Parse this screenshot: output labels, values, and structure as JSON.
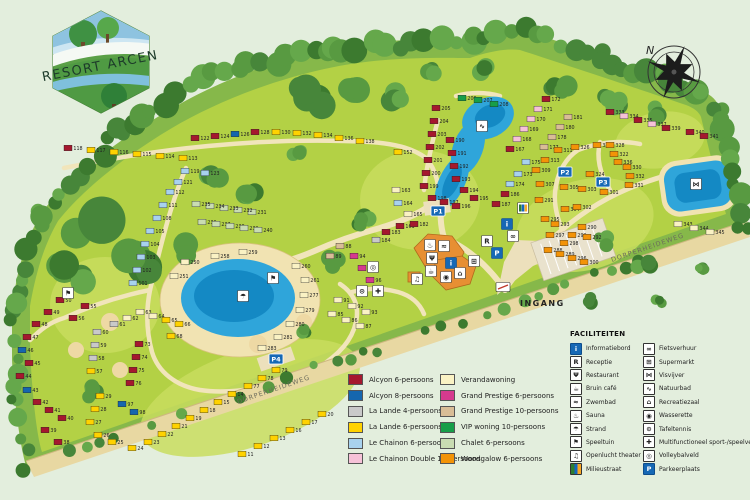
{
  "logo": {
    "title": "RESORT ARCEN"
  },
  "compass": {
    "north_label": "N"
  },
  "map_labels": {
    "entrance": "INGANG",
    "road_bottom": "DORPERHEIDEWEG",
    "road_right": "DORPERHEIDEWEG"
  },
  "parking_signs": [
    {
      "label": "P1",
      "x": 438,
      "y": 211
    },
    {
      "label": "P2",
      "x": 565,
      "y": 172
    },
    {
      "label": "P3",
      "x": 603,
      "y": 182
    },
    {
      "label": "P4",
      "x": 276,
      "y": 359
    }
  ],
  "unit_colors": {
    "a6": "#a5182e",
    "a8": "#1566ae",
    "l4": "#c9c9c9",
    "l6": "#ffd200",
    "c6": "#a8d2ee",
    "c12": "#f6c2d8",
    "vw": "#faf2c4",
    "gp6": "#d63a8e",
    "gp10": "#d9bd97",
    "vip": "#179e49",
    "ch": "#c9dcb2",
    "wg": "#f39307"
  },
  "accommodation_legend": [
    {
      "key": "a6",
      "label": "Alcyon 6-persoons",
      "color": "#a5182e"
    },
    {
      "key": "a8",
      "label": "Alcyon 8-persoons",
      "color": "#1566ae"
    },
    {
      "key": "l4",
      "label": "La Lande 4-persoons",
      "color": "#c9c9c9"
    },
    {
      "key": "l6",
      "label": "La Lande 6-persoons",
      "color": "#ffd200"
    },
    {
      "key": "c6",
      "label": "Le Chainon 6-persoons",
      "color": "#a8d2ee"
    },
    {
      "key": "c12",
      "label": "Le Chainon Double 12-persoons",
      "color": "#f6c2d8"
    },
    {
      "key": "vw",
      "label": "Verandawoning",
      "color": "#faf2c4"
    },
    {
      "key": "gp6",
      "label": "Grand Prestige 6-persoons",
      "color": "#d63a8e"
    },
    {
      "key": "gp10",
      "label": "Grand Prestige 10-persoons",
      "color": "#d9bd97"
    },
    {
      "key": "vip",
      "label": "VIP woning 10-persoons",
      "color": "#179e49"
    },
    {
      "key": "ch",
      "label": "Chalet 6-persoons",
      "color": "#c9dcb2"
    },
    {
      "key": "wg",
      "label": "Woodgalow 6-persoons",
      "color": "#f39307"
    }
  ],
  "facilities_legend": {
    "title": "FACILITEITEN",
    "left": [
      {
        "type": "informatiebord",
        "label": "Informatiebord"
      },
      {
        "type": "receptie",
        "label": "Receptie"
      },
      {
        "type": "restaurant",
        "label": "Restaurant"
      },
      {
        "type": "bruin-cafe",
        "label": "Bruin café"
      },
      {
        "type": "zwembad",
        "label": "Zwembad"
      },
      {
        "type": "sauna",
        "label": "Sauna"
      },
      {
        "type": "strand",
        "label": "Strand"
      },
      {
        "type": "speeltuin",
        "label": "Speeltuin"
      },
      {
        "type": "openlucht-theater",
        "label": "Openlucht theater"
      },
      {
        "type": "milieustraat",
        "label": "Milieustraat"
      }
    ],
    "right": [
      {
        "type": "fietsverhuur",
        "label": "Fietsverhuur"
      },
      {
        "type": "supermarkt",
        "label": "Supermarkt"
      },
      {
        "type": "visvijver",
        "label": "Visvijver"
      },
      {
        "type": "natuurbad",
        "label": "Natuurbad"
      },
      {
        "type": "recreatiezaal",
        "label": "Recreatiezaal"
      },
      {
        "type": "wasserette",
        "label": "Wasserette"
      },
      {
        "type": "tafeltennis",
        "label": "Tafeltennis"
      },
      {
        "type": "multifunctioneel",
        "label": "Multifunctioneel sport-/speelveld"
      },
      {
        "type": "volleybalveld",
        "label": "Volleybalveld"
      },
      {
        "type": "parkeerplaats",
        "label": "Parkeerplaats"
      }
    ]
  },
  "facility_glyphs": {
    "informatiebord": "i",
    "receptie": "R",
    "restaurant": "Ψ",
    "bruin-cafe": "☕",
    "zwembad": "≈",
    "sauna": "♨",
    "strand": "☂",
    "speeltuin": "⚑",
    "openlucht-theater": "♫",
    "milieustraat": "▥",
    "fietsverhuur": "∞",
    "supermarkt": "⊞",
    "visvijver": "⋈",
    "natuurbad": "∿",
    "recreatiezaal": "⌂",
    "wasserette": "◉",
    "tafeltennis": "⊙",
    "multifunctioneel": "✚",
    "volleybalveld": "◎",
    "parkeerplaats": "P",
    "entrance-gate": "▭"
  },
  "map_icons": [
    {
      "type": "sauna",
      "x": 430,
      "y": 245
    },
    {
      "type": "zwembad",
      "x": 444,
      "y": 246
    },
    {
      "type": "restaurant",
      "x": 432,
      "y": 258
    },
    {
      "type": "informatiebord",
      "x": 451,
      "y": 263,
      "blue": true
    },
    {
      "type": "bruin-cafe",
      "x": 431,
      "y": 271
    },
    {
      "type": "wasserette",
      "x": 446,
      "y": 277
    },
    {
      "type": "recreatiezaal",
      "x": 460,
      "y": 273
    },
    {
      "type": "openlucht-theater",
      "x": 417,
      "y": 279
    },
    {
      "type": "supermarkt",
      "x": 474,
      "y": 261
    },
    {
      "type": "receptie",
      "x": 487,
      "y": 241
    },
    {
      "type": "parkeerplaats",
      "x": 497,
      "y": 253,
      "blue": true
    },
    {
      "type": "informatiebord",
      "x": 507,
      "y": 224,
      "blue": true
    },
    {
      "type": "fietsverhuur",
      "x": 513,
      "y": 236
    },
    {
      "type": "milieustraat",
      "x": 523,
      "y": 208
    },
    {
      "type": "strand",
      "x": 243,
      "y": 296
    },
    {
      "type": "speeltuin",
      "x": 273,
      "y": 278
    },
    {
      "type": "speeltuin",
      "x": 68,
      "y": 293
    },
    {
      "type": "visvijver",
      "x": 696,
      "y": 184
    },
    {
      "type": "natuurbad",
      "x": 482,
      "y": 126
    },
    {
      "type": "volleybalveld",
      "x": 373,
      "y": 267
    },
    {
      "type": "multifunctioneel",
      "x": 378,
      "y": 291
    },
    {
      "type": "tafeltennis",
      "x": 362,
      "y": 291
    },
    {
      "type": "entrance-gate",
      "x": 503,
      "y": 287
    }
  ],
  "units": [
    [
      118,
      "a6",
      68,
      148
    ],
    [
      117,
      "l6",
      91,
      150
    ],
    [
      116,
      "l6",
      114,
      152
    ],
    [
      115,
      "l6",
      137,
      154
    ],
    [
      114,
      "l6",
      160,
      156
    ],
    [
      113,
      "l6",
      183,
      158
    ],
    [
      122,
      "a6",
      195,
      138
    ],
    [
      124,
      "a6",
      215,
      136
    ],
    [
      126,
      "a8",
      235,
      134
    ],
    [
      128,
      "a6",
      255,
      132
    ],
    [
      130,
      "l6",
      276,
      132
    ],
    [
      132,
      "l6",
      297,
      133
    ],
    [
      134,
      "l6",
      318,
      135
    ],
    [
      136,
      "l6",
      339,
      138
    ],
    [
      138,
      "l6",
      360,
      141
    ],
    [
      152,
      "l6",
      398,
      152
    ],
    [
      119,
      "c6",
      185,
      171
    ],
    [
      121,
      "c6",
      178,
      182
    ],
    [
      123,
      "c6",
      205,
      173
    ],
    [
      112,
      "c6",
      170,
      192
    ],
    [
      111,
      "c6",
      163,
      205
    ],
    [
      108,
      "c6",
      157,
      218
    ],
    [
      105,
      "c6",
      150,
      231
    ],
    [
      104,
      "c6",
      145,
      244
    ],
    [
      103,
      "c6",
      141,
      257
    ],
    [
      102,
      "c6",
      137,
      270
    ],
    [
      101,
      "c6",
      133,
      283
    ],
    [
      231,
      "ch",
      252,
      212
    ],
    [
      232,
      "ch",
      238,
      210
    ],
    [
      233,
      "ch",
      224,
      208
    ],
    [
      234,
      "ch",
      210,
      206
    ],
    [
      235,
      "ch",
      196,
      204
    ],
    [
      236,
      "ch",
      202,
      222
    ],
    [
      237,
      "ch",
      216,
      224
    ],
    [
      238,
      "ch",
      230,
      226
    ],
    [
      239,
      "ch",
      244,
      228
    ],
    [
      240,
      "ch",
      258,
      230
    ],
    [
      250,
      "vw",
      185,
      262
    ],
    [
      251,
      "vw",
      174,
      276
    ],
    [
      258,
      "vw",
      215,
      256
    ],
    [
      259,
      "vw",
      243,
      252
    ],
    [
      260,
      "vw",
      296,
      266
    ],
    [
      261,
      "vw",
      305,
      280
    ],
    [
      277,
      "vw",
      304,
      295
    ],
    [
      279,
      "vw",
      300,
      310
    ],
    [
      280,
      "vw",
      290,
      324
    ],
    [
      281,
      "vw",
      278,
      337
    ],
    [
      283,
      "vw",
      262,
      348
    ],
    [
      50,
      "a6",
      60,
      300
    ],
    [
      49,
      "a6",
      48,
      312
    ],
    [
      48,
      "a6",
      36,
      324
    ],
    [
      47,
      "a6",
      27,
      337
    ],
    [
      46,
      "a8",
      22,
      350
    ],
    [
      45,
      "a6",
      29,
      363
    ],
    [
      44,
      "a6",
      20,
      376
    ],
    [
      43,
      "a8",
      27,
      390
    ],
    [
      42,
      "a6",
      37,
      402
    ],
    [
      41,
      "a6",
      49,
      410
    ],
    [
      40,
      "a6",
      62,
      418
    ],
    [
      39,
      "a6",
      45,
      430
    ],
    [
      38,
      "a6",
      58,
      442
    ],
    [
      55,
      "a6",
      85,
      306
    ],
    [
      56,
      "a6",
      73,
      318
    ],
    [
      60,
      "l4",
      97,
      332
    ],
    [
      59,
      "l4",
      95,
      345
    ],
    [
      58,
      "l4",
      93,
      358
    ],
    [
      57,
      "l6",
      91,
      371
    ],
    [
      61,
      "l4",
      114,
      324
    ],
    [
      62,
      "vw",
      127,
      318
    ],
    [
      63,
      "vw",
      140,
      312
    ],
    [
      64,
      "vw",
      153,
      316
    ],
    [
      65,
      "l6",
      166,
      320
    ],
    [
      66,
      "l6",
      179,
      324
    ],
    [
      68,
      "l6",
      171,
      336
    ],
    [
      73,
      "a6",
      139,
      344
    ],
    [
      74,
      "a6",
      136,
      357
    ],
    [
      75,
      "a6",
      133,
      370
    ],
    [
      76,
      "a6",
      130,
      383
    ],
    [
      29,
      "l6",
      100,
      396
    ],
    [
      28,
      "l6",
      95,
      409
    ],
    [
      27,
      "l6",
      90,
      422
    ],
    [
      26,
      "l6",
      98,
      435
    ],
    [
      25,
      "l6",
      112,
      442
    ],
    [
      24,
      "l6",
      132,
      448
    ],
    [
      23,
      "l6",
      148,
      442
    ],
    [
      22,
      "l6",
      162,
      434
    ],
    [
      21,
      "l6",
      176,
      426
    ],
    [
      19,
      "l6",
      190,
      418
    ],
    [
      18,
      "l6",
      204,
      410
    ],
    [
      15,
      "l6",
      218,
      402
    ],
    [
      14,
      "l6",
      232,
      394
    ],
    [
      77,
      "l6",
      248,
      386
    ],
    [
      78,
      "l6",
      262,
      378
    ],
    [
      79,
      "l6",
      276,
      370
    ],
    [
      11,
      "l6",
      242,
      454
    ],
    [
      12,
      "l6",
      258,
      446
    ],
    [
      13,
      "l6",
      274,
      438
    ],
    [
      16,
      "l6",
      290,
      430
    ],
    [
      17,
      "l6",
      306,
      422
    ],
    [
      20,
      "l6",
      322,
      414
    ],
    [
      97,
      "a8",
      122,
      404
    ],
    [
      98,
      "a8",
      134,
      412
    ],
    [
      91,
      "vw",
      338,
      300
    ],
    [
      92,
      "vw",
      352,
      306
    ],
    [
      93,
      "vw",
      366,
      312
    ],
    [
      85,
      "vw",
      332,
      314
    ],
    [
      86,
      "vw",
      346,
      320
    ],
    [
      87,
      "vw",
      360,
      326
    ],
    [
      94,
      "gp6",
      354,
      256
    ],
    [
      95,
      "gp6",
      362,
      268
    ],
    [
      96,
      "gp6",
      370,
      280
    ],
    [
      88,
      "gp10",
      340,
      246
    ],
    [
      89,
      "gp10",
      330,
      256
    ],
    [
      161,
      "a6",
      400,
      226
    ],
    [
      163,
      "vw",
      396,
      190
    ],
    [
      164,
      "c6",
      398,
      203
    ],
    [
      165,
      "vw",
      408,
      214
    ],
    [
      182,
      "a6",
      414,
      224
    ],
    [
      183,
      "a6",
      386,
      232
    ],
    [
      184,
      "l4",
      376,
      240
    ],
    [
      205,
      "a6",
      436,
      108
    ],
    [
      204,
      "a6",
      434,
      121
    ],
    [
      203,
      "a6",
      432,
      134
    ],
    [
      202,
      "a6",
      430,
      147
    ],
    [
      201,
      "a6",
      428,
      160
    ],
    [
      200,
      "a6",
      426,
      173
    ],
    [
      199,
      "a6",
      424,
      186
    ],
    [
      190,
      "a6",
      450,
      140
    ],
    [
      191,
      "a6",
      452,
      153
    ],
    [
      192,
      "a6",
      454,
      166
    ],
    [
      193,
      "a6",
      456,
      179
    ],
    [
      198,
      "a6",
      432,
      198
    ],
    [
      197,
      "a6",
      444,
      202
    ],
    [
      196,
      "a6",
      456,
      206
    ],
    [
      194,
      "a6",
      464,
      190
    ],
    [
      195,
      "a6",
      474,
      198
    ],
    [
      206,
      "vip",
      462,
      98
    ],
    [
      207,
      "vip",
      478,
      100
    ],
    [
      208,
      "vip",
      494,
      104
    ],
    [
      172,
      "a6",
      546,
      99
    ],
    [
      171,
      "c12",
      538,
      109
    ],
    [
      170,
      "c12",
      531,
      119
    ],
    [
      169,
      "c12",
      524,
      129
    ],
    [
      168,
      "c12",
      517,
      139
    ],
    [
      167,
      "a6",
      510,
      149
    ],
    [
      175,
      "c6",
      526,
      162
    ],
    [
      173,
      "c6",
      518,
      174
    ],
    [
      174,
      "c6",
      510,
      184
    ],
    [
      177,
      "gp10",
      544,
      147
    ],
    [
      178,
      "gp10",
      552,
      137
    ],
    [
      180,
      "gp10",
      560,
      127
    ],
    [
      181,
      "gp10",
      568,
      117
    ],
    [
      186,
      "a6",
      505,
      194
    ],
    [
      187,
      "a6",
      496,
      204
    ],
    [
      311,
      "wg",
      558,
      150
    ],
    [
      313,
      "wg",
      545,
      160
    ],
    [
      309,
      "wg",
      536,
      170
    ],
    [
      307,
      "wg",
      540,
      184
    ],
    [
      305,
      "wg",
      564,
      187
    ],
    [
      303,
      "wg",
      582,
      189
    ],
    [
      301,
      "wg",
      604,
      192
    ],
    [
      326,
      "wg",
      575,
      147
    ],
    [
      320,
      "wg",
      597,
      145
    ],
    [
      328,
      "wg",
      610,
      145
    ],
    [
      322,
      "wg",
      614,
      154
    ],
    [
      324,
      "wg",
      590,
      174
    ],
    [
      336,
      "wg",
      618,
      162
    ],
    [
      330,
      "wg",
      627,
      167
    ],
    [
      332,
      "wg",
      630,
      176
    ],
    [
      331,
      "wg",
      629,
      185
    ],
    [
      291,
      "wg",
      539,
      200
    ],
    [
      295,
      "wg",
      545,
      219
    ],
    [
      304,
      "wg",
      565,
      209
    ],
    [
      302,
      "wg",
      577,
      207
    ],
    [
      293,
      "wg",
      555,
      224
    ],
    [
      297,
      "wg",
      550,
      235
    ],
    [
      299,
      "wg",
      572,
      235
    ],
    [
      298,
      "wg",
      564,
      243
    ],
    [
      290,
      "wg",
      582,
      227
    ],
    [
      292,
      "wg",
      587,
      237
    ],
    [
      288,
      "wg",
      548,
      250
    ],
    [
      289,
      "wg",
      560,
      254
    ],
    [
      296,
      "wg",
      572,
      258
    ],
    [
      300,
      "wg",
      584,
      262
    ],
    [
      333,
      "a6",
      610,
      112
    ],
    [
      334,
      "c12",
      624,
      116
    ],
    [
      335,
      "a6",
      638,
      120
    ],
    [
      337,
      "c12",
      652,
      124
    ],
    [
      339,
      "a6",
      666,
      128
    ],
    [
      340,
      "a6",
      690,
      132
    ],
    [
      341,
      "a6",
      704,
      136
    ],
    [
      343,
      "vw",
      678,
      224
    ],
    [
      344,
      "vw",
      694,
      228
    ],
    [
      345,
      "vw",
      710,
      232
    ]
  ]
}
